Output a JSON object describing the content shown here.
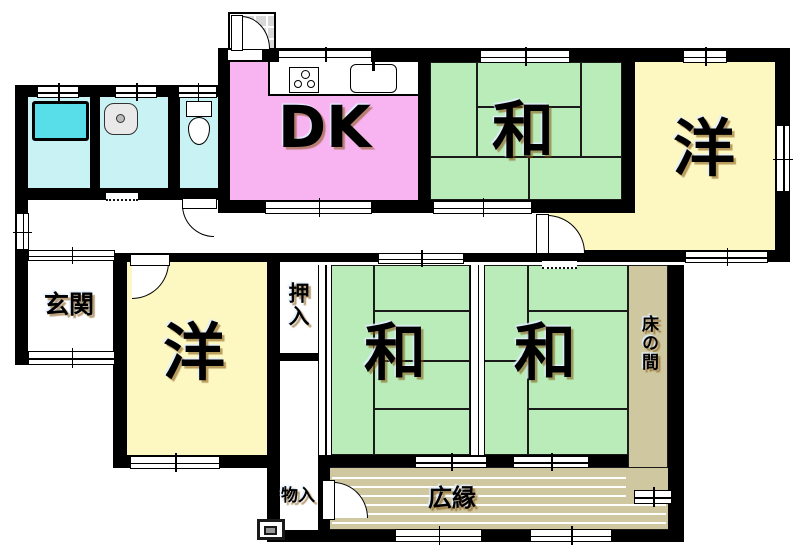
{
  "floorplan": {
    "type": "madori (Japanese floor plan)",
    "rooms": {
      "dk": {
        "label": "DK"
      },
      "wa_top": {
        "label": "和"
      },
      "yo_top": {
        "label": "洋"
      },
      "yo_lower": {
        "label": "洋"
      },
      "wa_lower_left": {
        "label": "和"
      },
      "wa_lower_right": {
        "label": "和"
      },
      "genkan": {
        "label": "玄関"
      },
      "oshiire": {
        "label": "押入"
      },
      "monoire": {
        "label": "物入"
      },
      "tokonoma": {
        "label": "床の間"
      },
      "hiroen": {
        "label": "広縁"
      }
    },
    "fixtures": [
      "bathtub",
      "washbasin",
      "toilet",
      "gas-stove",
      "kitchen-sink",
      "entry-step"
    ],
    "colors": {
      "dk": "#F8B4F0",
      "tatami": "#B9ECB9",
      "western": "#FDF8C2",
      "wet_area": "#C9F2F4",
      "bathtub": "#58DEE8",
      "wood": "#CFC7A0",
      "tile": "#D8D8D8",
      "wall": "#000000"
    }
  }
}
